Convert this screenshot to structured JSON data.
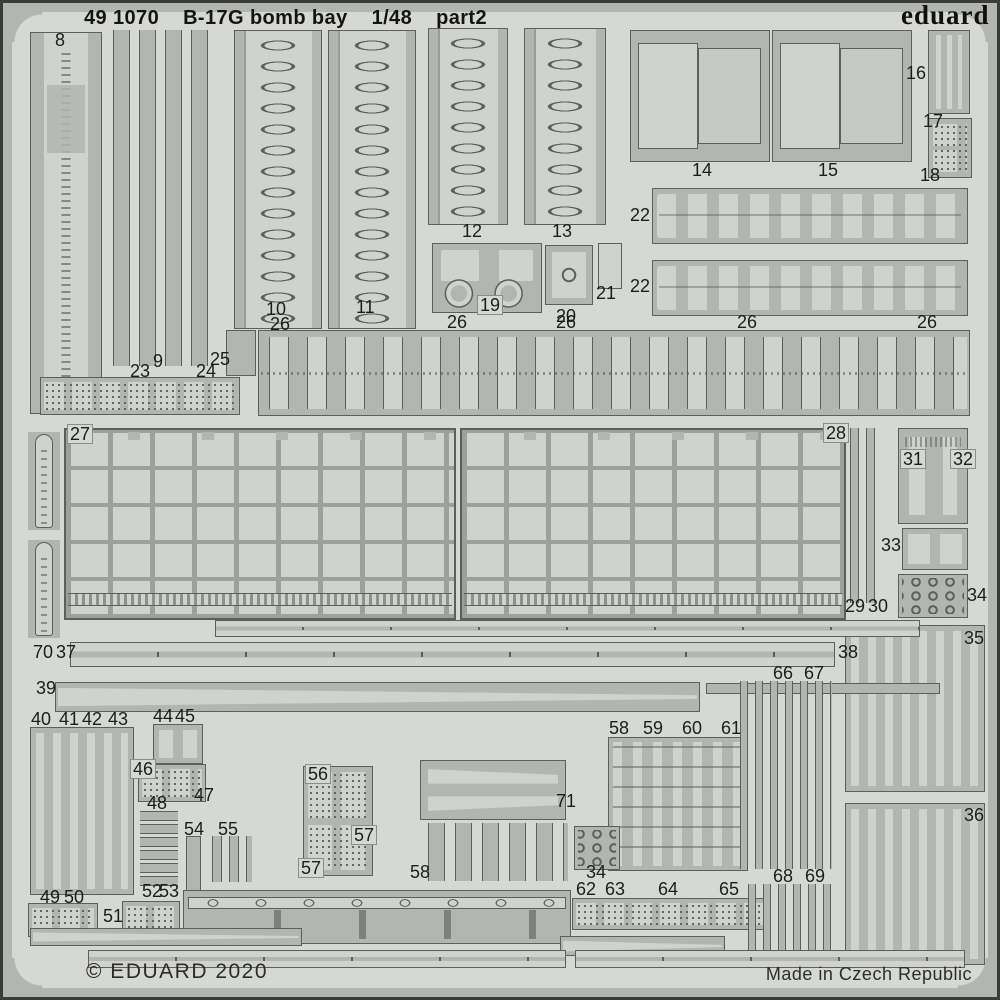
{
  "header": {
    "catalog": "49 1070",
    "title": "B-17G bomb bay",
    "scale": "1/48",
    "part": "part2"
  },
  "brand": {
    "logo": "eduard"
  },
  "footer": {
    "copyright": "© EDUARD 2020",
    "origin": "Made in Czech Republic"
  },
  "colors": {
    "sheet": "#d6d8d4",
    "metal": "#b2b5b0",
    "metal_dark": "#9da09b",
    "etched_light": "#cfd2cd",
    "outline": "#5c5f5a",
    "text": "#1c1e1b"
  },
  "fret": {
    "part_numbers": [
      "8",
      "9",
      "10",
      "11",
      "12",
      "13",
      "14",
      "15",
      "16",
      "17",
      "18",
      "19",
      "20",
      "21",
      "22",
      "23",
      "24",
      "25",
      "26",
      "27",
      "28",
      "29",
      "30",
      "31",
      "32",
      "33",
      "34",
      "35",
      "36",
      "37",
      "38",
      "39",
      "40",
      "41",
      "42",
      "43",
      "44",
      "45",
      "46",
      "47",
      "48",
      "49",
      "50",
      "51",
      "52",
      "53",
      "54",
      "55",
      "56",
      "57",
      "58",
      "59",
      "60",
      "61",
      "62",
      "63",
      "64",
      "65",
      "66",
      "67",
      "68",
      "69",
      "70",
      "71"
    ],
    "parts": [
      {
        "id": "8",
        "kind": "walkway",
        "x": 30,
        "y": 32,
        "w": 72,
        "h": 382
      },
      {
        "id": "9",
        "kind": "vstrips",
        "x": 113,
        "y": 30,
        "w": 102,
        "h": 336,
        "pw": 17,
        "pp": 26
      },
      {
        "id": "23-24",
        "kind": "flaps",
        "x": 40,
        "y": 377,
        "w": 200,
        "h": 38
      },
      {
        "id": "25",
        "kind": "plate",
        "x": 226,
        "y": 330,
        "w": 30,
        "h": 46
      },
      {
        "id": "10",
        "kind": "catwalk",
        "x": 234,
        "y": 30,
        "w": 88,
        "h": 299
      },
      {
        "id": "11",
        "kind": "catwalk",
        "x": 328,
        "y": 30,
        "w": 88,
        "h": 299
      },
      {
        "id": "12",
        "kind": "catwalk",
        "x": 428,
        "y": 28,
        "w": 80,
        "h": 197
      },
      {
        "id": "13",
        "kind": "catwalk",
        "x": 524,
        "y": 28,
        "w": 82,
        "h": 197
      },
      {
        "id": "19",
        "kind": "winch",
        "x": 432,
        "y": 243,
        "w": 110,
        "h": 70
      },
      {
        "id": "20",
        "kind": "plate-circle",
        "x": 546,
        "y": 246,
        "w": 46,
        "h": 58
      },
      {
        "id": "21",
        "kind": "plate-light",
        "x": 598,
        "y": 243,
        "w": 24,
        "h": 46
      },
      {
        "id": "14",
        "kind": "door",
        "x": 630,
        "y": 30,
        "w": 140,
        "h": 132
      },
      {
        "id": "15",
        "kind": "door",
        "x": 772,
        "y": 30,
        "w": 140,
        "h": 132
      },
      {
        "id": "16",
        "kind": "pins",
        "x": 928,
        "y": 30,
        "w": 42,
        "h": 84
      },
      {
        "id": "17-18",
        "kind": "flaps2",
        "x": 928,
        "y": 118,
        "w": 44,
        "h": 60
      },
      {
        "id": "22a",
        "kind": "shackles",
        "x": 652,
        "y": 188,
        "w": 316,
        "h": 56
      },
      {
        "id": "22b",
        "kind": "shackles",
        "x": 652,
        "y": 260,
        "w": 316,
        "h": 56
      },
      {
        "id": "26-row",
        "kind": "hingerow",
        "x": 258,
        "y": 330,
        "w": 712,
        "h": 86
      },
      {
        "id": "27",
        "kind": "lattice",
        "x": 64,
        "y": 428,
        "w": 392,
        "h": 192
      },
      {
        "id": "28",
        "kind": "lattice",
        "x": 460,
        "y": 428,
        "w": 386,
        "h": 192
      },
      {
        "id": "strap-a",
        "kind": "strap",
        "x": 28,
        "y": 432,
        "w": 32,
        "h": 98
      },
      {
        "id": "70",
        "kind": "strap",
        "x": 28,
        "y": 540,
        "w": 32,
        "h": 98
      },
      {
        "id": "29-30",
        "kind": "vstrips",
        "x": 850,
        "y": 428,
        "w": 32,
        "h": 175,
        "pw": 9,
        "pp": 16
      },
      {
        "id": "31-32",
        "kind": "tparts",
        "x": 898,
        "y": 428,
        "w": 70,
        "h": 96
      },
      {
        "id": "33",
        "kind": "aframe",
        "x": 902,
        "y": 528,
        "w": 66,
        "h": 42
      },
      {
        "id": "34a",
        "kind": "links",
        "x": 898,
        "y": 574,
        "w": 70,
        "h": 44
      },
      {
        "id": "35",
        "kind": "blades",
        "x": 845,
        "y": 625,
        "w": 140,
        "h": 167
      },
      {
        "id": "rail-a",
        "kind": "railpair",
        "x": 215,
        "y": 620,
        "w": 705,
        "h": 17
      },
      {
        "id": "37-38",
        "kind": "railpair",
        "x": 70,
        "y": 642,
        "w": 765,
        "h": 25
      },
      {
        "id": "39",
        "kind": "taper",
        "x": 55,
        "y": 682,
        "w": 645,
        "h": 30
      },
      {
        "id": "rail-b",
        "kind": "plate",
        "x": 706,
        "y": 683,
        "w": 234,
        "h": 11
      },
      {
        "id": "40-43",
        "kind": "blades",
        "x": 30,
        "y": 727,
        "w": 104,
        "h": 168
      },
      {
        "id": "44-45",
        "kind": "twotabs",
        "x": 153,
        "y": 724,
        "w": 50,
        "h": 40
      },
      {
        "id": "46-47",
        "kind": "flaps",
        "x": 138,
        "y": 764,
        "w": 68,
        "h": 38
      },
      {
        "id": "48",
        "kind": "hstack",
        "x": 140,
        "y": 810,
        "w": 38,
        "h": 76
      },
      {
        "id": "54",
        "kind": "plate",
        "x": 186,
        "y": 836,
        "w": 15,
        "h": 106
      },
      {
        "id": "55",
        "kind": "vstrips",
        "x": 212,
        "y": 836,
        "w": 40,
        "h": 46,
        "pw": 10,
        "pp": 17
      },
      {
        "id": "49-50",
        "kind": "flaps",
        "x": 28,
        "y": 903,
        "w": 70,
        "h": 34
      },
      {
        "id": "51-53",
        "kind": "flaps",
        "x": 122,
        "y": 901,
        "w": 58,
        "h": 37
      },
      {
        "id": "56-57",
        "kind": "flaps2",
        "x": 303,
        "y": 766,
        "w": 70,
        "h": 110
      },
      {
        "id": "71",
        "kind": "taperpair",
        "x": 420,
        "y": 760,
        "w": 146,
        "h": 60
      },
      {
        "id": "58b",
        "kind": "vstrips",
        "x": 428,
        "y": 823,
        "w": 140,
        "h": 58,
        "pw": 17,
        "pp": 27
      },
      {
        "id": "58-61",
        "kind": "ladder",
        "x": 608,
        "y": 737,
        "w": 140,
        "h": 134
      },
      {
        "id": "34b",
        "kind": "links",
        "x": 574,
        "y": 826,
        "w": 46,
        "h": 44
      },
      {
        "id": "62-65",
        "kind": "flaps",
        "x": 572,
        "y": 898,
        "w": 196,
        "h": 32
      },
      {
        "id": "66-67",
        "kind": "vstrips",
        "x": 740,
        "y": 681,
        "w": 92,
        "h": 188,
        "pw": 8,
        "pp": 15
      },
      {
        "id": "68-69",
        "kind": "vstrips",
        "x": 748,
        "y": 884,
        "w": 86,
        "h": 82,
        "pw": 8,
        "pp": 15
      },
      {
        "id": "36",
        "kind": "blades",
        "x": 845,
        "y": 803,
        "w": 140,
        "h": 162
      },
      {
        "id": "rail-bottom",
        "kind": "bottomrail",
        "x": 183,
        "y": 890,
        "w": 388,
        "h": 54
      },
      {
        "id": "taper-bl",
        "kind": "taper",
        "x": 30,
        "y": 928,
        "w": 272,
        "h": 18
      },
      {
        "id": "taper-br",
        "kind": "taper",
        "x": 560,
        "y": 936,
        "w": 165,
        "h": 20
      },
      {
        "id": "strip-bl",
        "kind": "railpair",
        "x": 88,
        "y": 950,
        "w": 478,
        "h": 18
      },
      {
        "id": "strip-br",
        "kind": "railpair",
        "x": 575,
        "y": 950,
        "w": 390,
        "h": 18
      }
    ],
    "labels": [
      {
        "text": "8",
        "x": 55,
        "y": 31
      },
      {
        "text": "9",
        "x": 153,
        "y": 352
      },
      {
        "text": "23",
        "x": 130,
        "y": 362
      },
      {
        "text": "24",
        "x": 196,
        "y": 362
      },
      {
        "text": "25",
        "x": 210,
        "y": 350
      },
      {
        "text": "10",
        "x": 266,
        "y": 300
      },
      {
        "text": "26",
        "x": 270,
        "y": 315
      },
      {
        "text": "11",
        "x": 356,
        "y": 298
      },
      {
        "text": "12",
        "x": 462,
        "y": 222
      },
      {
        "text": "13",
        "x": 552,
        "y": 222
      },
      {
        "text": "19",
        "x": 478,
        "y": 296,
        "boxed": true
      },
      {
        "text": "20",
        "x": 556,
        "y": 307
      },
      {
        "text": "21",
        "x": 596,
        "y": 284
      },
      {
        "text": "26",
        "x": 447,
        "y": 313
      },
      {
        "text": "26",
        "x": 556,
        "y": 313
      },
      {
        "text": "26",
        "x": 737,
        "y": 313
      },
      {
        "text": "26",
        "x": 917,
        "y": 313
      },
      {
        "text": "14",
        "x": 692,
        "y": 161
      },
      {
        "text": "15",
        "x": 818,
        "y": 161
      },
      {
        "text": "16",
        "x": 906,
        "y": 64
      },
      {
        "text": "17",
        "x": 923,
        "y": 112
      },
      {
        "text": "18",
        "x": 920,
        "y": 166
      },
      {
        "text": "22",
        "x": 630,
        "y": 206
      },
      {
        "text": "22",
        "x": 630,
        "y": 277
      },
      {
        "text": "27",
        "x": 68,
        "y": 425,
        "boxed": true
      },
      {
        "text": "28",
        "x": 824,
        "y": 424,
        "boxed": true
      },
      {
        "text": "29",
        "x": 845,
        "y": 597
      },
      {
        "text": "30",
        "x": 868,
        "y": 597
      },
      {
        "text": "31",
        "x": 901,
        "y": 450,
        "boxed": true
      },
      {
        "text": "32",
        "x": 951,
        "y": 450,
        "boxed": true
      },
      {
        "text": "33",
        "x": 881,
        "y": 536
      },
      {
        "text": "34",
        "x": 967,
        "y": 586
      },
      {
        "text": "35",
        "x": 964,
        "y": 629
      },
      {
        "text": "70",
        "x": 33,
        "y": 643
      },
      {
        "text": "37",
        "x": 56,
        "y": 643
      },
      {
        "text": "38",
        "x": 838,
        "y": 643
      },
      {
        "text": "39",
        "x": 36,
        "y": 679
      },
      {
        "text": "40",
        "x": 31,
        "y": 710
      },
      {
        "text": "41",
        "x": 59,
        "y": 710
      },
      {
        "text": "42",
        "x": 82,
        "y": 710
      },
      {
        "text": "43",
        "x": 108,
        "y": 710
      },
      {
        "text": "44",
        "x": 153,
        "y": 707
      },
      {
        "text": "45",
        "x": 175,
        "y": 707
      },
      {
        "text": "46",
        "x": 131,
        "y": 760,
        "boxed": true
      },
      {
        "text": "47",
        "x": 194,
        "y": 786
      },
      {
        "text": "48",
        "x": 147,
        "y": 794
      },
      {
        "text": "54",
        "x": 184,
        "y": 820
      },
      {
        "text": "55",
        "x": 218,
        "y": 820
      },
      {
        "text": "49",
        "x": 40,
        "y": 888
      },
      {
        "text": "50",
        "x": 64,
        "y": 888
      },
      {
        "text": "51",
        "x": 103,
        "y": 907
      },
      {
        "text": "52",
        "x": 142,
        "y": 882
      },
      {
        "text": "53",
        "x": 159,
        "y": 882
      },
      {
        "text": "56",
        "x": 306,
        "y": 765,
        "boxed": true
      },
      {
        "text": "57",
        "x": 352,
        "y": 826,
        "boxed": true
      },
      {
        "text": "57",
        "x": 299,
        "y": 859,
        "boxed": true
      },
      {
        "text": "71",
        "x": 556,
        "y": 792
      },
      {
        "text": "58",
        "x": 410,
        "y": 863
      },
      {
        "text": "58",
        "x": 609,
        "y": 719
      },
      {
        "text": "59",
        "x": 643,
        "y": 719
      },
      {
        "text": "60",
        "x": 682,
        "y": 719
      },
      {
        "text": "61",
        "x": 721,
        "y": 719
      },
      {
        "text": "34",
        "x": 586,
        "y": 863
      },
      {
        "text": "62",
        "x": 576,
        "y": 880
      },
      {
        "text": "63",
        "x": 605,
        "y": 880
      },
      {
        "text": "64",
        "x": 658,
        "y": 880
      },
      {
        "text": "65",
        "x": 719,
        "y": 880
      },
      {
        "text": "66",
        "x": 773,
        "y": 664
      },
      {
        "text": "67",
        "x": 804,
        "y": 664
      },
      {
        "text": "68",
        "x": 773,
        "y": 867
      },
      {
        "text": "69",
        "x": 805,
        "y": 867
      },
      {
        "text": "36",
        "x": 964,
        "y": 806
      }
    ]
  }
}
